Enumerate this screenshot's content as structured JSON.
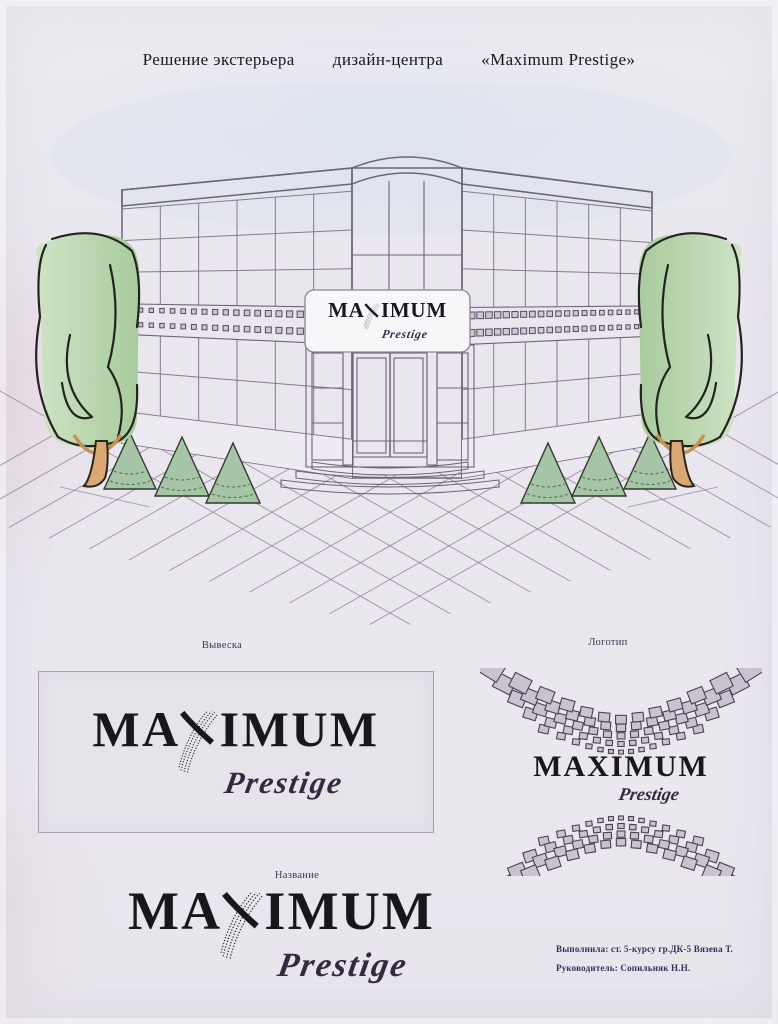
{
  "page": {
    "title_parts": [
      "Решение экстерьера",
      "дизайн-центра",
      "«Maximum Prestige»"
    ]
  },
  "brand": {
    "name": "MAXIMUM",
    "name_prefix": "MA",
    "name_suffix": "IMUM",
    "tagline": "Prestige"
  },
  "labels": {
    "signboard": "Вывеска",
    "logo": "Логотип",
    "name": "Название"
  },
  "credits": {
    "line1": "Выполнила: ст. 5-курсу гр.ДК-5 Вязева Т.",
    "line2": "Руководитель: Сопильняк Н.Н."
  },
  "colors": {
    "paper": "#e9e6ee",
    "ink": "#1a171c",
    "sketch-line": "#6f6378",
    "script-ink": "#332a40",
    "credits-ink": "#34305c",
    "glass": "#d6d2de",
    "tree-green": "#b9d3ae",
    "bush-green": "#a6c5a6",
    "trunk-tan": "#d9a873",
    "sky-blue": "#d9e3ee"
  }
}
